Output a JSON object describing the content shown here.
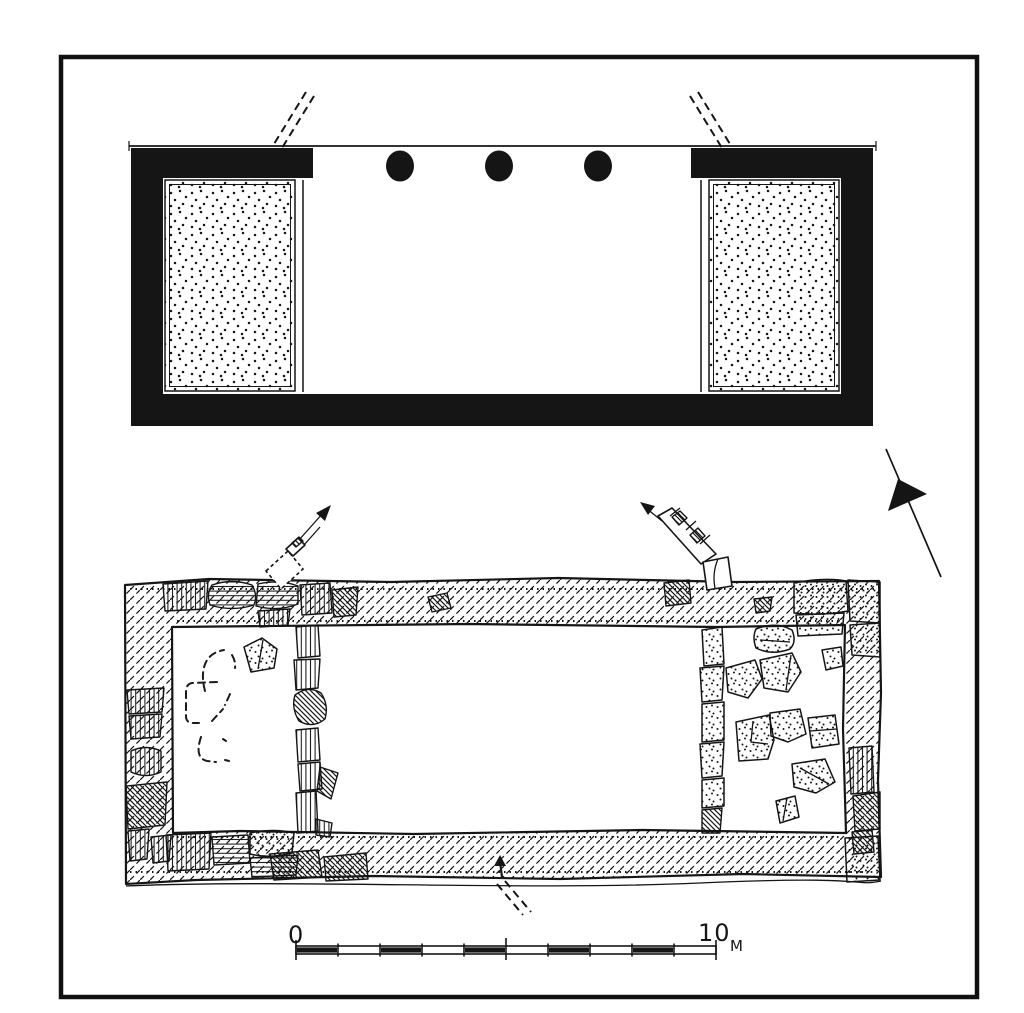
{
  "figure": {
    "ink_color": "#151515",
    "paper_color": "#ffffff"
  },
  "restored_plan": {
    "column_count": 3,
    "stippled_platform_count": 2
  },
  "excavation_plan": {
    "room_count": 3
  },
  "north_arrow": {
    "direction": "upper-left"
  },
  "scale_bar": {
    "zero_label": "0",
    "end_label": "10",
    "unit_label": "M",
    "meters_total": 10,
    "segment_count": 10,
    "filled_segments_1based": [
      1,
      3,
      5,
      7,
      9
    ]
  }
}
